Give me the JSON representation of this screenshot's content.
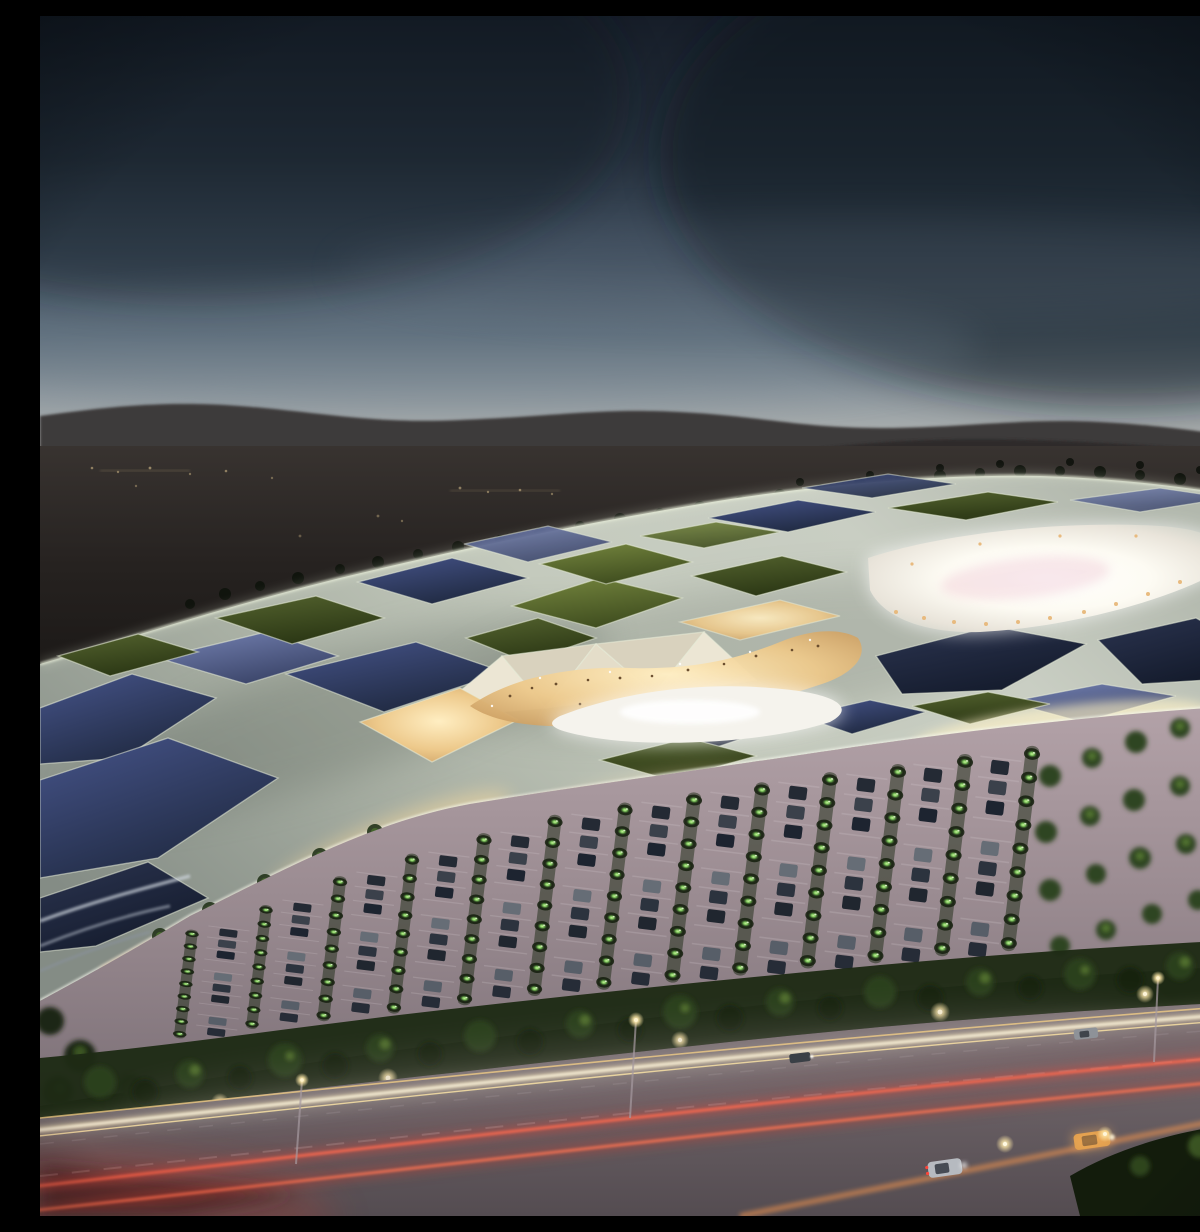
{
  "image": {
    "alt": "Aerial dusk rendering of a futuristic shopping mall with an organic lattice canopy roof, glowing interior promenades and courtyard, a tree-lined parking lot, and a highway with car light trails",
    "time_of_day": "dusk",
    "style": "architectural visualization"
  },
  "scene": {
    "background": [
      "overcast gradient sky",
      "dark mountain ridge on horizon",
      "dim plains with scattered distant lights"
    ],
    "midground": [
      "organic canopy roof with cellular skylights",
      "dark glass cells",
      "green roof-garden cells",
      "cream translucent panels",
      "warm lit promenade openings",
      "bright white pool plaza",
      "bright central courtyard",
      "glowing ribbed front facade"
    ],
    "foreground": [
      "pink-grey parking lot",
      "rows of parked cars",
      "rows of glowing green trees",
      "dense tree band",
      "multi-lane highway",
      "headlight and taillight trails",
      "cars on road",
      "street lamps"
    ]
  },
  "palette": {
    "sky_top": "#161d28",
    "sky_mid": "#3f4e5e",
    "sky_horizon": "#bdbdb8",
    "mountains": "#3e3a3a",
    "plains": "#1c1916",
    "roof_shell": "#c2c8bc",
    "roof_rib_glow": "#eaf0da",
    "glass_cell": "#2b3450",
    "garden_cell": "#55642f",
    "cream_panel": "#ece6d4",
    "interior_glow": "#edc98b",
    "courtyard_glow": "#ffffff",
    "courtyard_pink": "#efc6d2",
    "parking_surface": "#998a90",
    "tree_glow": "#7cc45c",
    "road_surface": "#6b6167",
    "headlight_trail": "#fff8e2",
    "taillight_trail": "#e84b3c"
  },
  "counts": {
    "parking_tree_rows": 13,
    "parking_car_rows": 12,
    "road_cars": 4,
    "street_lamp_poles": 3
  }
}
